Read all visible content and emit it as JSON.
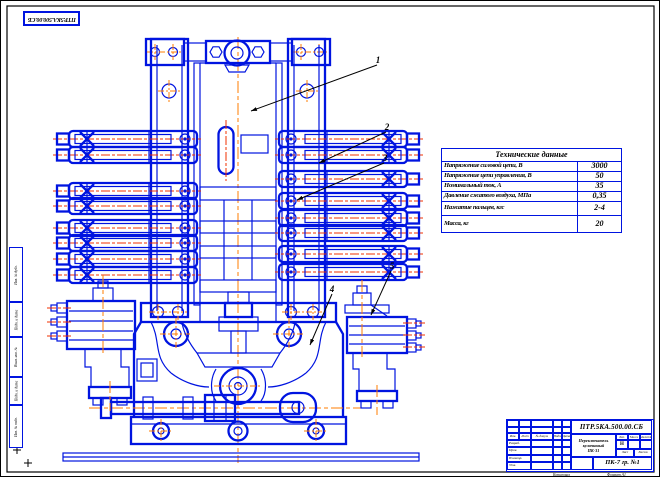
{
  "colors": {
    "line_blue": "#0014e0",
    "centerline_orange": "#ff7d00",
    "centerline_red": "#f03000",
    "frame_black": "#000000"
  },
  "top_stamp": {
    "designation": "ПТР.5КА.500.00.СБ"
  },
  "tech_table": {
    "title": "Технические данные",
    "rows": [
      {
        "label": "Напряжение силовой цепи, В",
        "value": "3000"
      },
      {
        "label": "Напряжение цепи управления, В",
        "value": "50"
      },
      {
        "label": "Номинальный ток, А",
        "value": "35"
      },
      {
        "label": "Давление сжатого воздуха, МПа",
        "value": "0,35"
      },
      {
        "label": "Нажатие пальцев, кгс",
        "value": "2-4"
      },
      {
        "label": "Масса, кг",
        "value": "20"
      }
    ]
  },
  "callouts": {
    "labels": [
      "1",
      "2",
      "3",
      "4",
      "5"
    ]
  },
  "margin_strip": {
    "labels": [
      "Инв. № дубл.",
      "Подп. и дата",
      "Взам. инв. №",
      "Подп. и дата",
      "Инв. № подл."
    ]
  },
  "title_block": {
    "designation": "ПТР.5КА.500.00.СБ",
    "name_lines": [
      "Переключатель",
      "кулачковый",
      "ПК-31"
    ],
    "group": "ПК-7 гр. №1",
    "header_cols": [
      "Изм.",
      "Лист",
      "№ докум.",
      "Подп.",
      "Дата"
    ],
    "row_labels": [
      "Разраб.",
      "Пров.",
      "Н.контр.",
      "Утв."
    ],
    "lit": "Лит.",
    "lit_value": "Н",
    "mass": "Масса",
    "scale": "Масштаб",
    "sheet": "Лист",
    "sheets": "Листов",
    "copied": "Копировал",
    "format": "Формат А1"
  }
}
